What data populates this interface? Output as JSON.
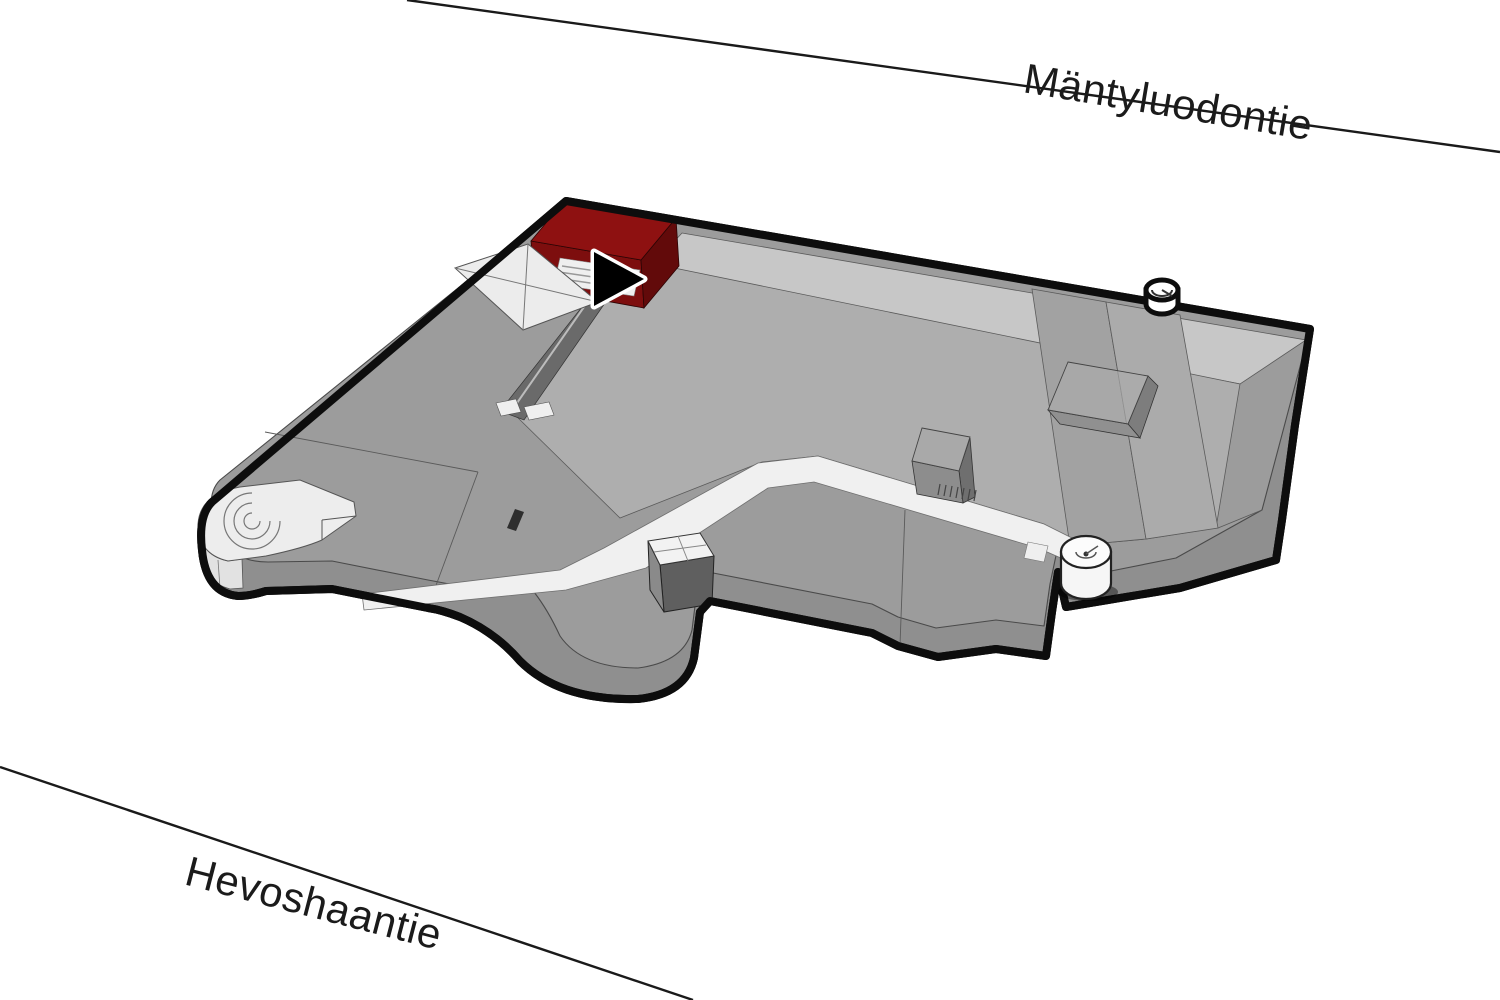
{
  "scene": {
    "type": "indoor-3d-map",
    "background": "#ffffff",
    "description": "3D isometric shopping-centre floor map between two streets with one unit highlighted"
  },
  "streets": {
    "top": "Mäntyluodontie",
    "bottom": "Hevoshaantie"
  },
  "highlight": {
    "unit": "highlighted-unit",
    "top_color": "#8e1111",
    "left_face_color": "#7d0e0e",
    "right_face_color": "#620a0a"
  },
  "marker": {
    "shape": "triangle-right",
    "fill": "#000000",
    "outline": "#ffffff"
  },
  "palette": {
    "outline": "#0d0d0d",
    "base_side": "#8f8f8f",
    "floor": "#9c9c9c",
    "floor_center": "#aeaeae",
    "floor_strip_a": "#a2a2a2",
    "floor_strip_b": "#ababab",
    "top_band": "#c7c7c7",
    "corridor": "#f0f0f0",
    "wall_dark": "#6a6a6a",
    "white_structure": "#f2f2f2",
    "road_line": "#1a1a1a"
  }
}
